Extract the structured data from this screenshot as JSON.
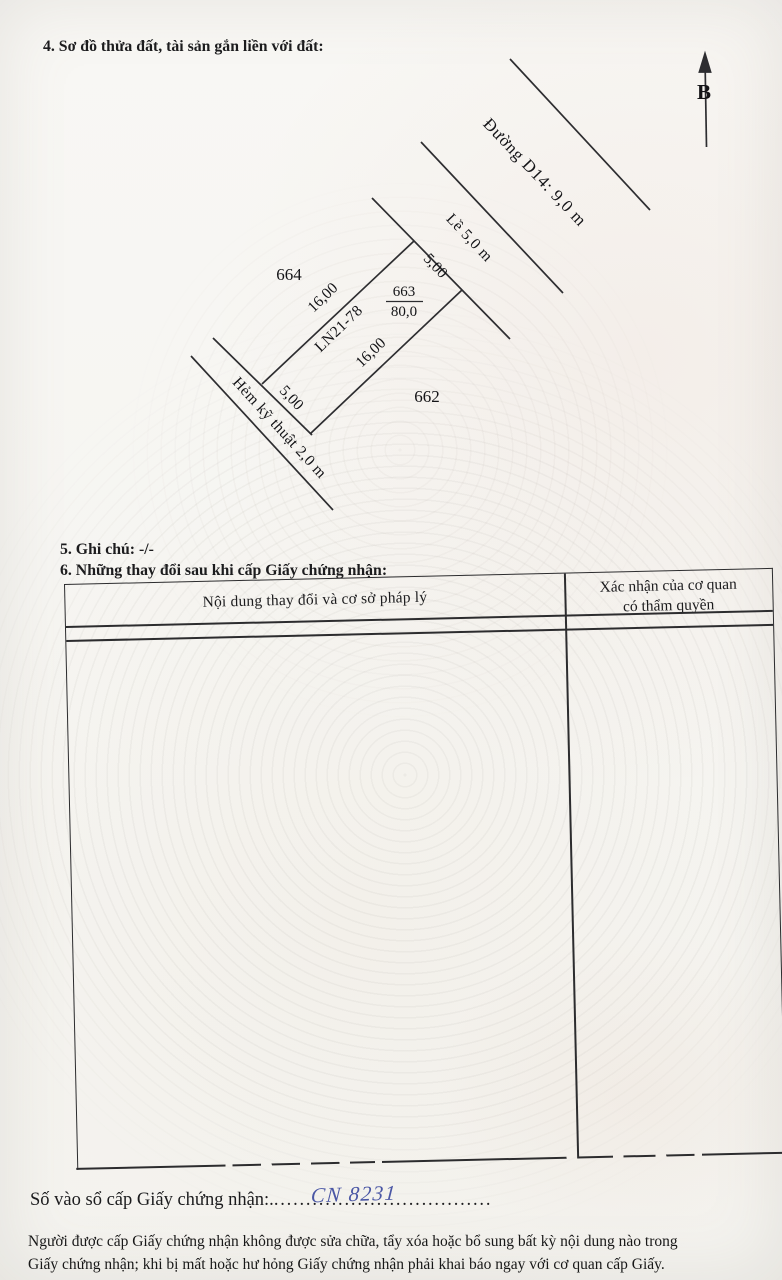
{
  "sections": {
    "s4": "4. Sơ đồ thửa đất, tài sản gắn liền với đất:",
    "s5": "5. Ghi chú: -/-",
    "s6": "6. Những thay đổi sau khi cấp Giấy chứng nhận:"
  },
  "diagram": {
    "north_indicator": "B",
    "road_label": "Đường D14: 9,0 m",
    "sidewalk_label": "Lề 5,0 m",
    "alley_label": "Hẻm kỹ thuật 2,0 m",
    "parcel": {
      "number": "663",
      "area": "80,0",
      "code": "LN21-78"
    },
    "adjacent_parcel_left": "664",
    "adjacent_parcel_right": "662",
    "dims": {
      "front": "5,00",
      "left": "16,00",
      "right": "16,00",
      "rear": "5,00"
    }
  },
  "changes_table": {
    "col1_header": "Nội dung thay đổi và cơ sở pháp lý",
    "col2_header_line1": "Xác nhận của cơ quan",
    "col2_header_line2": "có thẩm quyền"
  },
  "footer": {
    "serial_label": "Số vào sổ cấp Giấy chứng nhận:.",
    "serial_value": "CN 8231",
    "serial_dots": "..................................",
    "legal_line1": "Người được cấp Giấy chứng nhận không được sửa chữa, tẩy xóa hoặc bổ sung bất kỳ nội dung nào trong",
    "legal_line2": "Giấy chứng nhận; khi bị mất hoặc hư hỏng Giấy chứng nhận phải khai báo ngay với cơ quan cấp Giấy."
  },
  "colors": {
    "ink": "#1c1c1e",
    "line": "#2d2d30",
    "handwriting_blue": "#4a57a5",
    "paper": "#f6f5f1"
  }
}
